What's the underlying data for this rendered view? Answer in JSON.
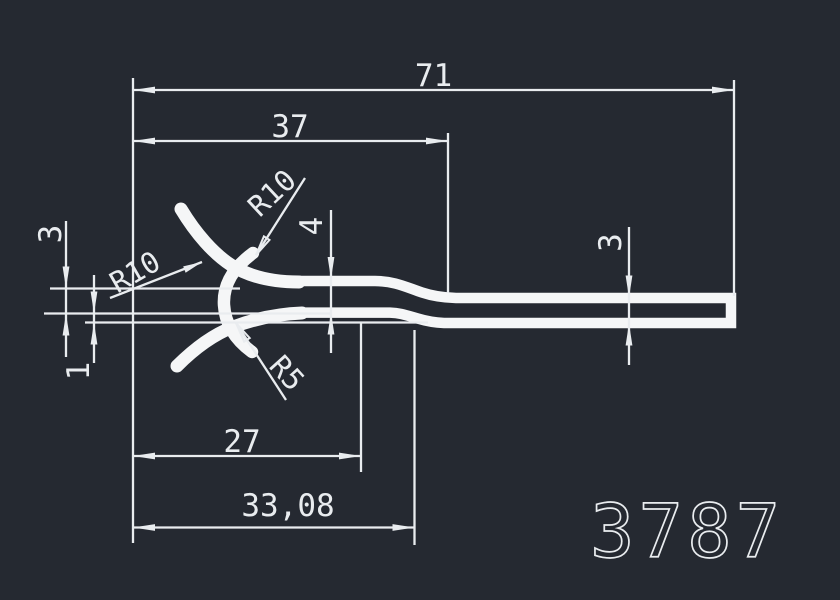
{
  "drawing": {
    "part_number": "3787",
    "colors": {
      "background": "#252931",
      "line": "#e9ecef",
      "profile": "#f5f6f7"
    },
    "dimensions": {
      "width_overall": "71",
      "width_upper": "37",
      "width_claw": "27",
      "width_mid": "33,08",
      "thickness_left": "4",
      "thickness_right": "3",
      "height_left": "3",
      "gap_left": "1"
    },
    "radii": {
      "upper": "R10",
      "left": "R10",
      "lower": "R5"
    }
  }
}
